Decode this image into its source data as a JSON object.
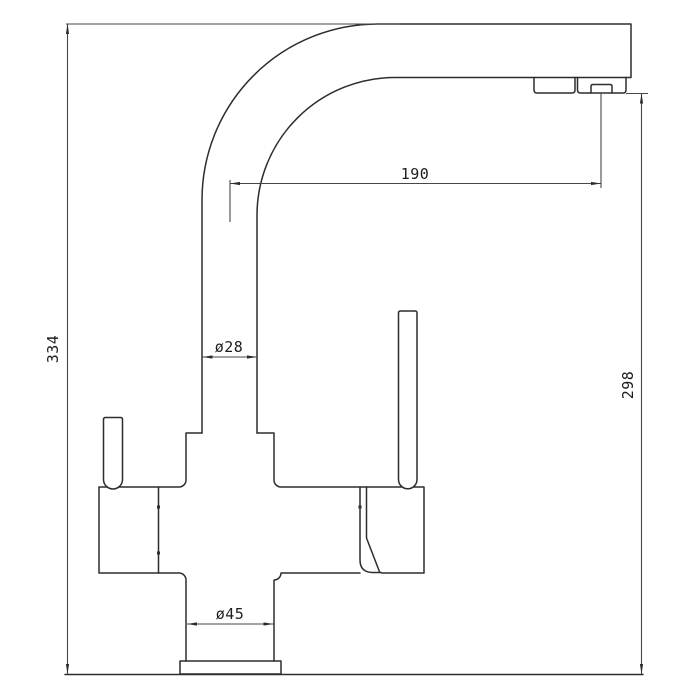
{
  "page": {
    "background": "#ffffff"
  },
  "drawing": {
    "subject": "three-way kitchen faucet dimensional diagram",
    "view": "side elevation",
    "line_color": "#2d2d2d",
    "dimension_line_color": "#474747",
    "labels": {
      "overall_height": "334",
      "spout_reach": "190",
      "outlet_height": "298",
      "spout_pipe_diameter": "ø28",
      "body_diameter": "ø45"
    }
  }
}
